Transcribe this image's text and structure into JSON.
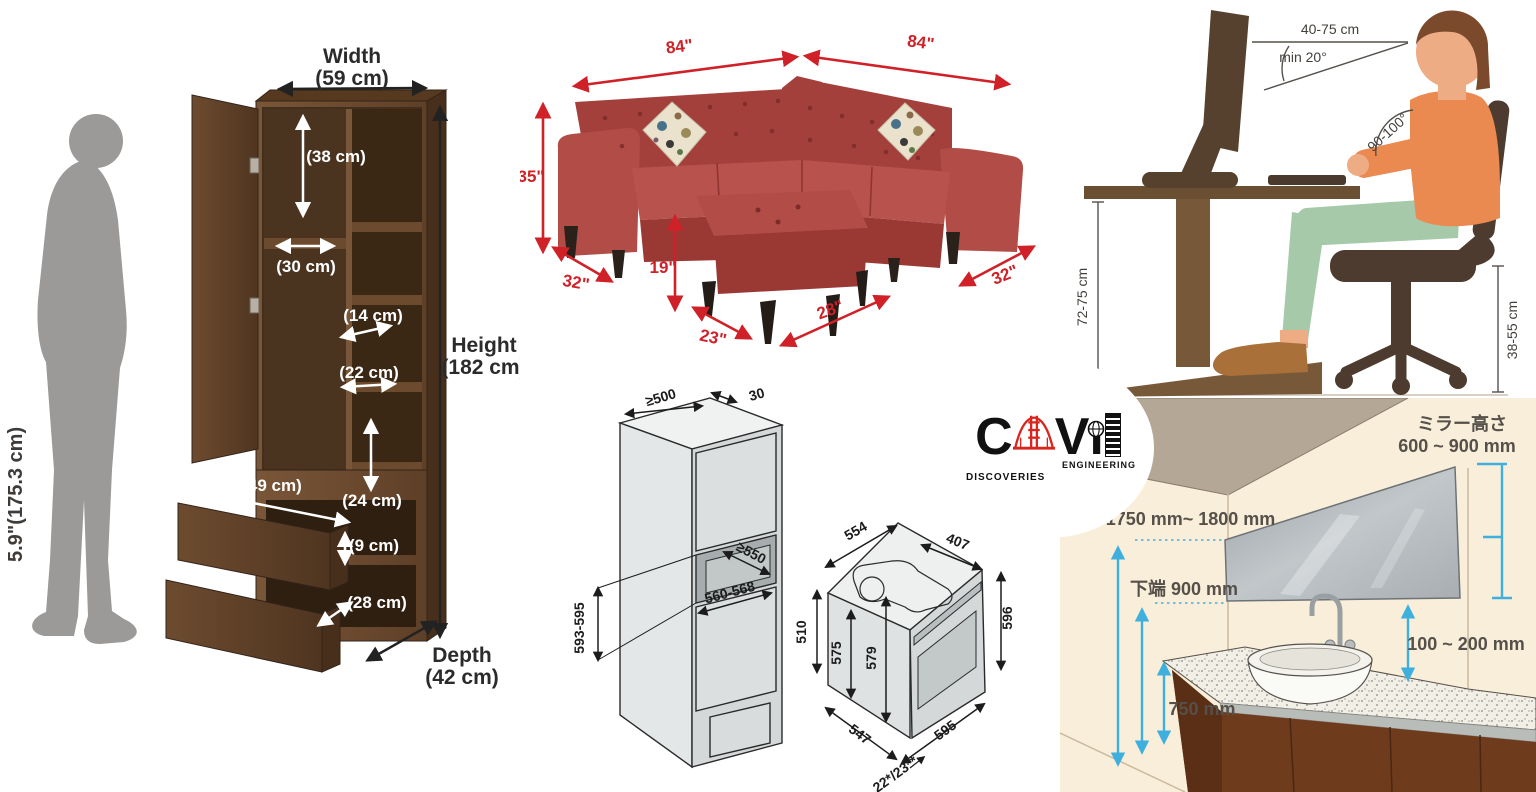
{
  "collage": {
    "wardrobe": {
      "person_height": "5.9\"(175.3 cm)",
      "width_label": "Width",
      "width_value": "(59 cm)",
      "height_label": "Height",
      "height_value": "(182 cm)",
      "depth_label": "Depth",
      "depth_value": "(42 cm)",
      "shelf_38": "(38 cm)",
      "shelf_30": "(30 cm)",
      "shelf_14": "(14 cm)",
      "shelf_22": "(22 cm)",
      "shelf_24": "(24 cm)",
      "drawer_width": "(49 cm)",
      "drawer_height": "(9 cm)",
      "drawer_depth": "(28 cm)"
    },
    "sofa": {
      "width_left": "84\"",
      "width_right": "84\"",
      "back_height": "35\"",
      "depth_left": "32\"",
      "depth_right": "32\"",
      "ottoman_height": "19\"",
      "ottoman_depth": "23\"",
      "ottoman_width": "28\""
    },
    "ergonomics": {
      "viewing_distance": "40-75 cm",
      "viewing_angle": "min 20°",
      "elbow_angle": "90-100°",
      "desk_height": "72-75 cm",
      "seat_height": "38-55 cm"
    },
    "oven": {
      "niche_top_width": "≥500",
      "rear_gap": "30",
      "niche_depth": "≥550",
      "niche_width": "560-568",
      "niche_height": "593-595",
      "oven_top_depth": "554",
      "oven_top_rear": "407",
      "oven_left_height": "510",
      "oven_inner_height": "575",
      "oven_mid_height": "579",
      "oven_right_height": "596",
      "oven_bottom_depth": "547",
      "oven_width": "595",
      "door_note": "22*/23**"
    },
    "bathroom": {
      "mirror_height_label": "ミラー高さ",
      "mirror_height_value": "600 ~ 900 mm",
      "mirror_top_edge": "上端 1750 mm~ 1800 mm",
      "mirror_bottom_edge": "下端 900 mm",
      "mirror_counter_gap": "100 ~ 200 mm",
      "counter_height": "750 mm"
    },
    "logo": {
      "letter_c": "C",
      "letter_v": "V",
      "letter_i": "ı",
      "word_engineering": "ENGINEERING",
      "word_discoveries": "DISCOVERIES"
    },
    "colors": {
      "dim_red": "#cf2127",
      "dim_cyan": "#3fb0dd",
      "wood": "#6a4a31",
      "sofa_red": "#b24c47",
      "shirt_orange": "#ea8950",
      "pants_green": "#a6c9a9",
      "wall_cream": "#f9eed9",
      "ceiling_taupe": "#b5a795",
      "logo_red": "#d9251d"
    }
  }
}
